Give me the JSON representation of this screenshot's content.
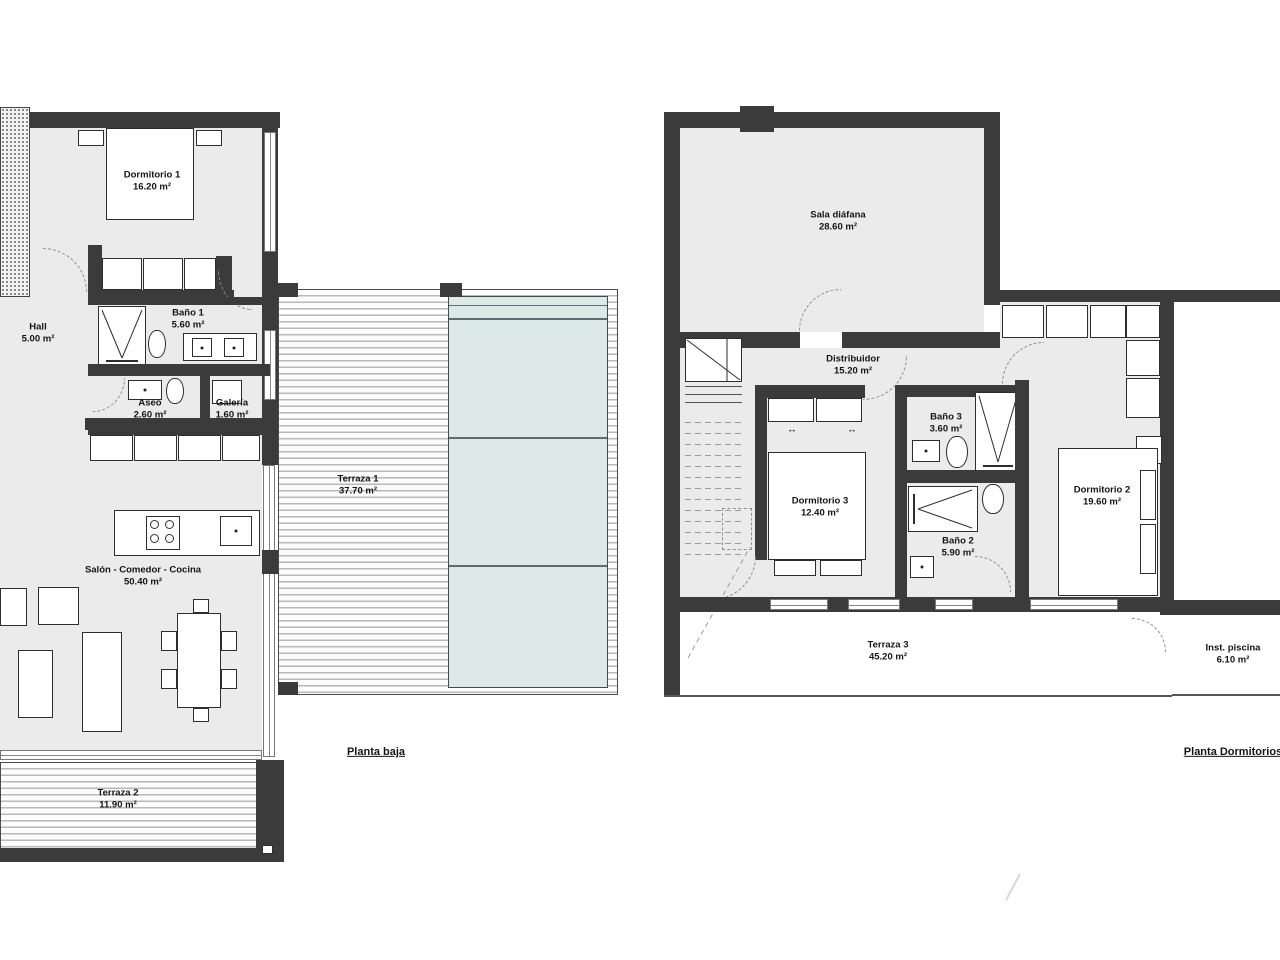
{
  "plans": {
    "ground": {
      "label": "Planta baja",
      "rooms": {
        "dormitorio1": {
          "name": "Dormitorio 1",
          "area": "16.20 m²"
        },
        "hall": {
          "name": "Hall",
          "area": "5.00 m²"
        },
        "bano1": {
          "name": "Baño 1",
          "area": "5.60 m²"
        },
        "aseo": {
          "name": "Aseo",
          "area": "2.60 m²"
        },
        "galeria": {
          "name": "Galería",
          "area": "1.60 m²"
        },
        "terraza1": {
          "name": "Terraza 1",
          "area": "37.70 m²"
        },
        "salon": {
          "name": "Salón - Comedor - Cocina",
          "area": "50.40 m²"
        },
        "terraza2": {
          "name": "Terraza 2",
          "area": "11.90 m²"
        }
      }
    },
    "upper": {
      "label": "Planta Dormitorios",
      "rooms": {
        "sala": {
          "name": "Sala diáfana",
          "area": "28.60 m²"
        },
        "distribuidor": {
          "name": "Distribuidor",
          "area": "15.20 m²"
        },
        "bano3": {
          "name": "Baño 3",
          "area": "3.60 m²"
        },
        "dormitorio3": {
          "name": "Dormitorio 3",
          "area": "12.40 m²"
        },
        "dormitorio2": {
          "name": "Dormitorio 2",
          "area": "19.60 m²"
        },
        "bano2": {
          "name": "Baño 2",
          "area": "5.90 m²"
        },
        "terraza3": {
          "name": "Terraza 3",
          "area": "45.20 m²"
        },
        "inst_piscina": {
          "name": "Inst. piscina",
          "area": "6.10 m²"
        }
      }
    }
  },
  "symbols": {
    "double_arrow": "↔"
  },
  "colors": {
    "wall": "#3b3b3b",
    "room_fill": "#ebebeb",
    "pool_fill": "#dde9e7",
    "line": "#333333"
  }
}
